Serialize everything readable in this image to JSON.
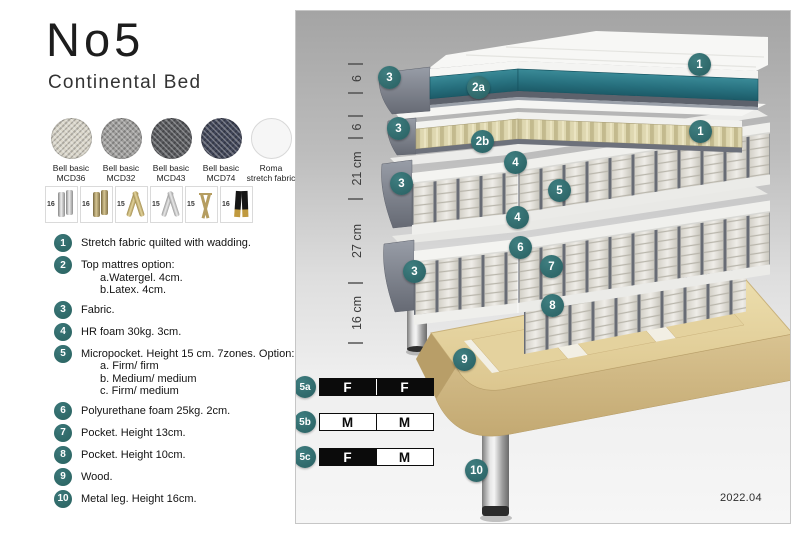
{
  "header": {
    "title": "No5",
    "subtitle": "Continental Bed"
  },
  "fabrics": [
    {
      "line1": "Bell basic",
      "line2": "MCD36",
      "color": "#d9d5c9"
    },
    {
      "line1": "Bell basic",
      "line2": "MCD32",
      "color": "#a09f9d"
    },
    {
      "line1": "Bell basic",
      "line2": "MCD43",
      "color": "#595a5e"
    },
    {
      "line1": "Bell basic",
      "line2": "MCD74",
      "color": "#414659"
    },
    {
      "line1": "Roma",
      "line2": "stretch fabric",
      "color": "#f6f6f6"
    }
  ],
  "legs": [
    {
      "height": "16",
      "style": "cylinder-chrome"
    },
    {
      "height": "16",
      "style": "cylinder-brass"
    },
    {
      "height": "15",
      "style": "twisted-gold"
    },
    {
      "height": "15",
      "style": "twisted-silver"
    },
    {
      "height": "15",
      "style": "hairpin-gold"
    },
    {
      "height": "16",
      "style": "block-black-gold"
    }
  ],
  "features": [
    {
      "num": "1",
      "text": "Stretch fabric quilted with wadding.",
      "sub": []
    },
    {
      "num": "2",
      "text": "Top mattres option:",
      "sub": [
        "a.Watergel. 4cm.",
        "b.Latex. 4cm."
      ]
    },
    {
      "num": "3",
      "text": "Fabric.",
      "sub": []
    },
    {
      "num": "4",
      "text": "HR foam 30kg. 3cm.",
      "sub": []
    },
    {
      "num": "5",
      "text": "Micropocket. Height 15 cm. 7zones. Option:",
      "sub": [
        "a. Firm/ firm",
        "b. Medium/ medium",
        "c. Firm/ medium"
      ]
    },
    {
      "num": "6",
      "text": "Polyurethane foam 25kg. 2cm.",
      "sub": []
    },
    {
      "num": "7",
      "text": "Pocket. Height 13cm.",
      "sub": []
    },
    {
      "num": "8",
      "text": "Pocket. Height 10cm.",
      "sub": []
    },
    {
      "num": "9",
      "text": "Wood.",
      "sub": []
    },
    {
      "num": "10",
      "text": "Metal leg. Height 16cm.",
      "sub": []
    }
  ],
  "diagram": {
    "dimensions": [
      "6",
      "6",
      "21 cm",
      "27 cm",
      "16 cm"
    ],
    "callouts": {
      "top1": "1",
      "mid1": "1",
      "c2a": "2a",
      "c2b": "2b",
      "c3a": "3",
      "c3b": "3",
      "c3c": "3",
      "c3d": "3",
      "c4a": "4",
      "c4b": "4",
      "c5": "5",
      "c6": "6",
      "c7": "7",
      "c8": "8",
      "c9": "9",
      "c10": "10"
    },
    "firmness": [
      {
        "label": "5a",
        "cells": [
          {
            "text": "F",
            "variant": "dark"
          },
          {
            "text": "F",
            "variant": "dark"
          }
        ]
      },
      {
        "label": "5b",
        "cells": [
          {
            "text": "M",
            "variant": "light"
          },
          {
            "text": "M",
            "variant": "light"
          }
        ]
      },
      {
        "label": "5c",
        "cells": [
          {
            "text": "F",
            "variant": "dark"
          },
          {
            "text": "M",
            "variant": "light"
          }
        ]
      }
    ],
    "version": "2022.04",
    "colors": {
      "badge_teal": "#2e6e70",
      "watergel_teal": "#27707e",
      "latex_cream": "#ded7b0",
      "fabric_wrap_gray": "#7c8089",
      "wood": "#e6d6a5",
      "firmness_dark": "#0b0b0b"
    }
  }
}
